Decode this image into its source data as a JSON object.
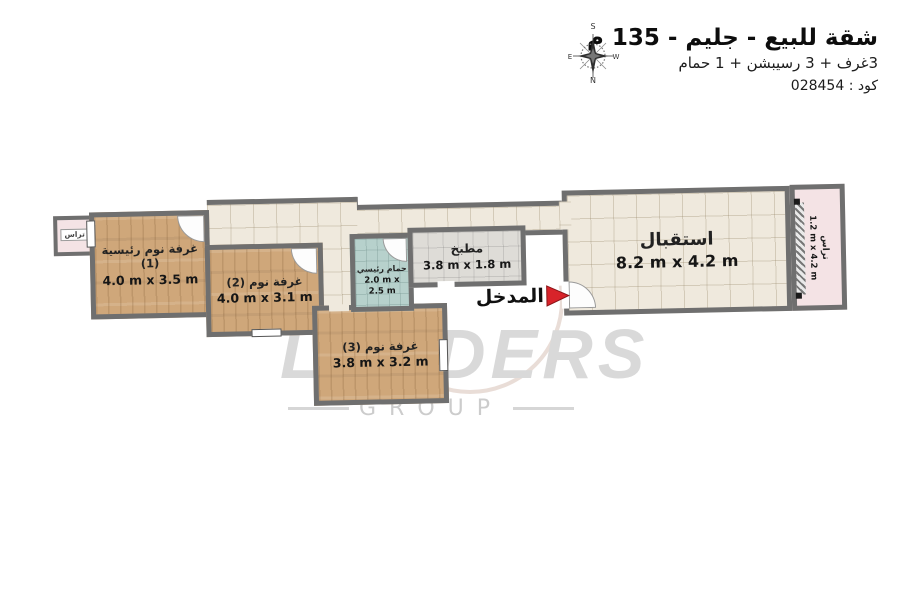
{
  "header": {
    "title": "شقة للبيع - جليم - 135 م",
    "subtitle": "3غرف + 3 رسيبشن + 1 حمام",
    "code_line": "كود : 028454",
    "compass": {
      "top": "S",
      "bottom": "N",
      "left": "E",
      "right": "W"
    }
  },
  "plan": {
    "entrance": {
      "label": "المدخل"
    },
    "rooms": {
      "terrace_left": {
        "name": "تراس"
      },
      "master_bedroom": {
        "name": "غرفة نوم رئيسية (1)",
        "dims": "4.0 m x 3.5 m"
      },
      "bedroom2": {
        "name": "غرفة نوم (2)",
        "dims": "4.0 m x 3.1 m"
      },
      "bedroom3": {
        "name": "غرفة نوم (3)",
        "dims": "3.8 m x 3.2 m"
      },
      "bathroom": {
        "name": "حمام رئيسي",
        "dims": "2.0 m x 2.5 m"
      },
      "kitchen": {
        "name": "مطبخ",
        "dims": "3.8 m x 1.8 m"
      },
      "reception": {
        "name": "استقبال",
        "dims": "8.2 m x 4.2 m"
      },
      "terrace_right": {
        "name": "تراس",
        "dims": "1.2 m x 4.2 m"
      }
    }
  },
  "watermark": {
    "brand": "LEADERS",
    "sub": "GROUP"
  },
  "colors": {
    "wall": "#6f6f6f",
    "wood_floor": "#cfa77a",
    "tile_floor": "#efe9dd",
    "kitchen_floor": "#dedcd7",
    "bathroom_floor": "#b7d1cc",
    "terrace_floor": "#f4e3e5",
    "entrance_arrow": "#d8232a",
    "watermark_gray": "#d9d9d9"
  }
}
